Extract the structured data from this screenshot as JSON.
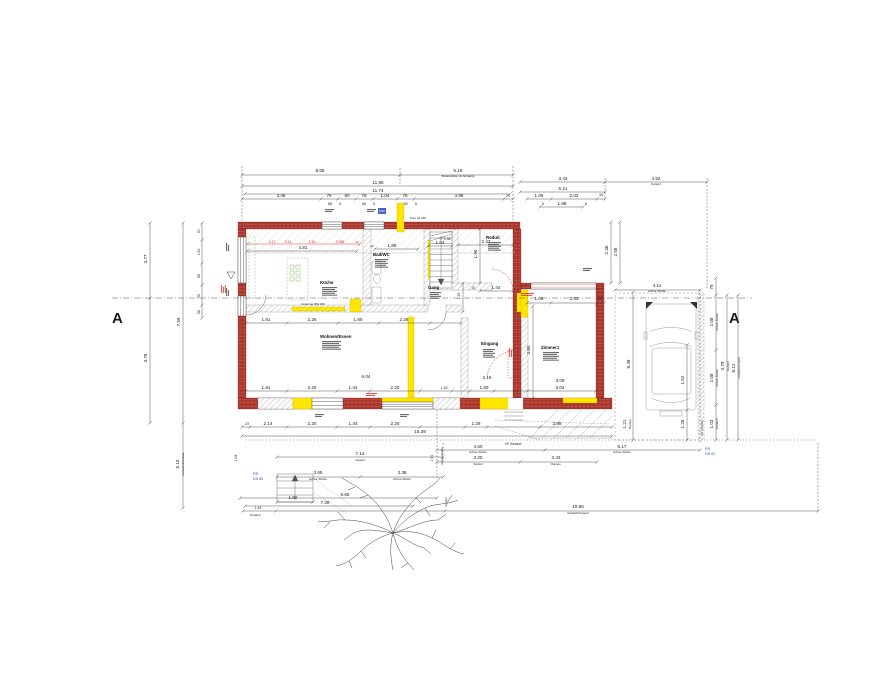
{
  "drawing": {
    "type": "floor-plan-ground-floor"
  },
  "section": {
    "left_marker": "A",
    "right_marker": "A"
  },
  "drains": {
    "left": {
      "line1": "RR",
      "line2": "DN 80"
    },
    "right": {
      "line1": "RR",
      "line2": "DN 60"
    }
  },
  "colors": {
    "wall_red": "#b13a31",
    "wall_red_dark": "#7a2018",
    "highlight_yellow": "#ffe600",
    "hatch_gray": "#9a9a9a",
    "kitchen_green": "#86bf6e",
    "dim_text": "#1a1a1a",
    "red_text": "#d02c1e",
    "blue_text": "#3a57c4",
    "line_gray": "#444444"
  },
  "rooms": [
    {
      "name": "Küche",
      "x": 320,
      "y": 284
    },
    {
      "name": "Bad/WC",
      "x": 373,
      "y": 256
    },
    {
      "name": "Gang",
      "x": 428,
      "y": 289
    },
    {
      "name": "Reduit",
      "x": 486,
      "y": 239
    },
    {
      "name": "Zimmer1",
      "x": 541,
      "y": 349
    },
    {
      "name": "Wohnen/Essen",
      "x": 320,
      "y": 338
    },
    {
      "name": "Eingang",
      "x": 481,
      "y": 345
    }
  ],
  "dim_lines": [
    {
      "x1": 242,
      "y1": 175,
      "x2": 400,
      "y2": 175
    },
    {
      "x1": 400,
      "y1": 175,
      "x2": 513,
      "y2": 175
    },
    {
      "x1": 242,
      "y1": 186,
      "x2": 513,
      "y2": 186
    },
    {
      "x1": 245,
      "y1": 194,
      "x2": 510,
      "y2": 194
    },
    {
      "x1": 242,
      "y1": 199,
      "x2": 513,
      "y2": 199,
      "ticks": [
        321,
        338,
        356,
        373,
        397,
        414,
        504
      ]
    },
    {
      "x1": 520,
      "y1": 182,
      "x2": 605,
      "y2": 182
    },
    {
      "x1": 605,
      "y1": 182,
      "x2": 707,
      "y2": 182
    },
    {
      "x1": 520,
      "y1": 192,
      "x2": 605,
      "y2": 192
    },
    {
      "x1": 527,
      "y1": 199,
      "x2": 605,
      "y2": 199,
      "ticks": [
        551,
        597
      ]
    },
    {
      "x1": 540,
      "y1": 207,
      "x2": 583,
      "y2": 207
    },
    {
      "x1": 611,
      "y1": 222,
      "x2": 611,
      "y2": 283
    },
    {
      "x1": 620,
      "y1": 222,
      "x2": 620,
      "y2": 283
    },
    {
      "x1": 615,
      "y1": 290,
      "x2": 700,
      "y2": 290
    },
    {
      "x1": 716,
      "y1": 278,
      "x2": 716,
      "y2": 440,
      "ticks": [
        295,
        350,
        405
      ]
    },
    {
      "x1": 727,
      "y1": 295,
      "x2": 727,
      "y2": 440
    },
    {
      "x1": 738,
      "y1": 295,
      "x2": 738,
      "y2": 440
    },
    {
      "x1": 150,
      "y1": 223,
      "x2": 150,
      "y2": 423,
      "ticks": [
        298
      ]
    },
    {
      "x1": 183,
      "y1": 223,
      "x2": 183,
      "y2": 508,
      "ticks": [
        423
      ]
    },
    {
      "x1": 202,
      "y1": 223,
      "x2": 202,
      "y2": 318,
      "ticks": [
        240,
        263,
        285,
        305
      ]
    },
    {
      "x1": 633,
      "y1": 292,
      "x2": 633,
      "y2": 440
    },
    {
      "x1": 687,
      "y1": 345,
      "x2": 687,
      "y2": 440,
      "ticks": [
        410
      ]
    },
    {
      "x1": 246,
      "y1": 391,
      "x2": 596,
      "y2": 391,
      "ticks": [
        287,
        337,
        370,
        420,
        452,
        470,
        494,
        528
      ]
    },
    {
      "x1": 242,
      "y1": 427,
      "x2": 612,
      "y2": 427,
      "ticks": [
        250,
        287,
        337,
        370,
        420,
        465,
        487,
        540
      ]
    },
    {
      "x1": 242,
      "y1": 436,
      "x2": 612,
      "y2": 436
    },
    {
      "x1": 277,
      "y1": 457,
      "x2": 443,
      "y2": 457
    },
    {
      "x1": 437,
      "y1": 450,
      "x2": 700,
      "y2": 450,
      "ticks": [
        545
      ]
    },
    {
      "x1": 437,
      "y1": 462,
      "x2": 597,
      "y2": 462,
      "ticks": [
        520
      ]
    },
    {
      "x1": 277,
      "y1": 477,
      "x2": 443,
      "y2": 477,
      "ticks": [
        360
      ]
    },
    {
      "x1": 240,
      "y1": 498,
      "x2": 437,
      "y2": 498
    },
    {
      "x1": 245,
      "y1": 506,
      "x2": 413,
      "y2": 506
    },
    {
      "x1": 243,
      "y1": 511,
      "x2": 818,
      "y2": 511,
      "ticks": [
        276,
        445
      ]
    },
    {
      "x1": 277,
      "y1": 502,
      "x2": 313,
      "y2": 502
    },
    {
      "x1": 527,
      "y1": 303,
      "x2": 604,
      "y2": 303,
      "ticks": [
        551,
        597
      ]
    },
    {
      "x1": 458,
      "y1": 245,
      "x2": 513,
      "y2": 245
    },
    {
      "x1": 480,
      "y1": 229,
      "x2": 480,
      "y2": 283
    },
    {
      "x1": 480,
      "y1": 291,
      "x2": 513,
      "y2": 291
    },
    {
      "x1": 463,
      "y1": 283,
      "x2": 463,
      "y2": 312
    },
    {
      "x1": 375,
      "y1": 249,
      "x2": 418,
      "y2": 249
    },
    {
      "x1": 428,
      "y1": 246,
      "x2": 452,
      "y2": 246
    },
    {
      "x1": 247,
      "y1": 244,
      "x2": 360,
      "y2": 244,
      "c": "red"
    },
    {
      "x1": 247,
      "y1": 251,
      "x2": 357,
      "y2": 251
    },
    {
      "x1": 246,
      "y1": 323,
      "x2": 461,
      "y2": 323,
      "ticks": [
        287,
        338,
        379,
        430
      ]
    },
    {
      "x1": 533,
      "y1": 306,
      "x2": 533,
      "y2": 398
    },
    {
      "x1": 437,
      "y1": 410,
      "x2": 437,
      "y2": 480,
      "d": 1
    },
    {
      "x1": 242,
      "y1": 166,
      "x2": 242,
      "y2": 222,
      "d": 1
    },
    {
      "x1": 513,
      "y1": 166,
      "x2": 513,
      "y2": 222,
      "d": 1
    },
    {
      "x1": 400,
      "y1": 168,
      "x2": 400,
      "y2": 186,
      "d": 1
    },
    {
      "x1": 605,
      "y1": 178,
      "x2": 605,
      "y2": 199,
      "d": 1
    },
    {
      "x1": 707,
      "y1": 178,
      "x2": 707,
      "y2": 290,
      "d": 1
    },
    {
      "x1": 818,
      "y1": 443,
      "x2": 818,
      "y2": 511,
      "d": 1
    },
    {
      "x1": 245,
      "y1": 440,
      "x2": 818,
      "y2": 440,
      "d": 2
    },
    {
      "x1": 112,
      "y1": 298,
      "x2": 752,
      "y2": 298,
      "d": 3
    },
    {
      "x1": 246,
      "y1": 253,
      "x2": 513,
      "y2": 253,
      "c": "#bbbbbb"
    },
    {
      "x1": 443,
      "y1": 443,
      "x2": 443,
      "y2": 462,
      "d": 1
    },
    {
      "x1": 700,
      "y1": 290,
      "x2": 700,
      "y2": 443,
      "d": 1
    }
  ],
  "labels": [
    {
      "t": "8.65",
      "x": 320,
      "y": 172
    },
    {
      "t": "5.19",
      "x": 458,
      "y": 172
    },
    {
      "t": "Bodenplatte vor Eingang",
      "x": 458,
      "y": 177,
      "s": 3
    },
    {
      "t": "11.96",
      "x": 378,
      "y": 184
    },
    {
      "t": "11.74",
      "x": 378,
      "y": 192
    },
    {
      "t": "3.48",
      "x": 281,
      "y": 197
    },
    {
      "t": "76",
      "x": 329,
      "y": 197
    },
    {
      "t": "80",
      "x": 347,
      "y": 197
    },
    {
      "t": "76",
      "x": 364,
      "y": 197
    },
    {
      "t": "1.04",
      "x": 385,
      "y": 197
    },
    {
      "t": "76",
      "x": 405,
      "y": 197
    },
    {
      "t": "3.98",
      "x": 459,
      "y": 197
    },
    {
      "t": "22",
      "x": 508,
      "y": 197,
      "s": 3.5
    },
    {
      "t": "68",
      "x": 330,
      "y": 205,
      "s": 3.5
    },
    {
      "t": "5",
      "x": 340,
      "y": 205,
      "s": 3.5
    },
    {
      "t": "66",
      "x": 364,
      "y": 205,
      "s": 3.5
    },
    {
      "t": "5",
      "x": 374,
      "y": 205,
      "s": 3.5
    },
    {
      "t": "92",
      "x": 406,
      "y": 205,
      "s": 3.5
    },
    {
      "t": "6",
      "x": 416,
      "y": 205,
      "s": 3.5
    },
    {
      "t": "Knie eff.160",
      "x": 418,
      "y": 219,
      "s": 3
    },
    {
      "t": "3.43",
      "x": 563,
      "y": 180
    },
    {
      "t": "4.52",
      "x": 656,
      "y": 180
    },
    {
      "t": "Carport",
      "x": 656,
      "y": 185,
      "s": 3
    },
    {
      "t": "5.21",
      "x": 563,
      "y": 190
    },
    {
      "t": "1.06",
      "x": 539,
      "y": 197
    },
    {
      "t": "2.03",
      "x": 574,
      "y": 197
    },
    {
      "t": "34",
      "x": 601,
      "y": 196,
      "s": 3.5
    },
    {
      "t": "1.88",
      "x": 562,
      "y": 205
    },
    {
      "t": "6",
      "x": 543,
      "y": 205,
      "s": 3.5
    },
    {
      "t": "6",
      "x": 586,
      "y": 205,
      "s": 3.5
    },
    {
      "t": "2.36",
      "x": 608,
      "y": 250,
      "r": 1
    },
    {
      "t": "2.58",
      "x": 617,
      "y": 252,
      "r": 1
    },
    {
      "t": "4.11",
      "x": 657,
      "y": 287
    },
    {
      "t": "Achse Stütze",
      "x": 657,
      "y": 292,
      "s": 3
    },
    {
      "t": "76",
      "x": 713,
      "y": 287,
      "r": 1
    },
    {
      "t": "2.08",
      "x": 713,
      "y": 322,
      "r": 1
    },
    {
      "t": "Achse Stütze",
      "x": 718,
      "y": 322,
      "s": 3,
      "r": 1
    },
    {
      "t": "2.08",
      "x": 713,
      "y": 378,
      "r": 1
    },
    {
      "t": "Achse Stütze",
      "x": 718,
      "y": 378,
      "s": 3,
      "r": 1
    },
    {
      "t": "1.03",
      "x": 713,
      "y": 424,
      "r": 1
    },
    {
      "t": "Vordach",
      "x": 718,
      "y": 424,
      "s": 3,
      "r": 1
    },
    {
      "t": "4.79",
      "x": 724,
      "y": 366,
      "r": 1
    },
    {
      "t": "Carport",
      "x": 729,
      "y": 366,
      "s": 3,
      "r": 1
    },
    {
      "t": "8.12",
      "x": 735,
      "y": 368,
      "r": 1
    },
    {
      "t": "Vordach/Carport",
      "x": 740,
      "y": 368,
      "s": 3,
      "r": 1
    },
    {
      "t": "VK Vordach",
      "x": 703,
      "y": 428,
      "s": 3,
      "r": 1
    },
    {
      "t": "3.77",
      "x": 147,
      "y": 259,
      "r": 1
    },
    {
      "t": "3.78",
      "x": 147,
      "y": 358,
      "r": 1
    },
    {
      "t": "7.59",
      "x": 180,
      "y": 322,
      "r": 1
    },
    {
      "t": "5.10",
      "x": 179,
      "y": 464,
      "r": 1
    },
    {
      "t": "Vordach/Postkast.",
      "x": 184,
      "y": 464,
      "s": 3,
      "r": 1
    },
    {
      "t": "61",
      "x": 200,
      "y": 231,
      "r": 1,
      "s": 3.5
    },
    {
      "t": "1.62",
      "x": 200,
      "y": 252,
      "r": 1,
      "s": 3.5
    },
    {
      "t": "58",
      "x": 200,
      "y": 276,
      "r": 1,
      "s": 3.5
    },
    {
      "t": "95",
      "x": 200,
      "y": 296,
      "r": 1,
      "s": 3.5
    },
    {
      "t": "58",
      "x": 200,
      "y": 312,
      "r": 1,
      "s": 3.5
    },
    {
      "t": "8.48",
      "x": 630,
      "y": 364,
      "r": 1
    },
    {
      "t": "1.21",
      "x": 626,
      "y": 424,
      "r": 1
    },
    {
      "t": "Rampe",
      "x": 631,
      "y": 424,
      "s": 3,
      "r": 1
    },
    {
      "t": "1.52",
      "x": 684,
      "y": 380,
      "r": 1
    },
    {
      "t": "1.26",
      "x": 684,
      "y": 424,
      "r": 1
    },
    {
      "t": "1.81",
      "x": 266,
      "y": 389
    },
    {
      "t": "2.20",
      "x": 312,
      "y": 389
    },
    {
      "t": "1.44",
      "x": 353,
      "y": 389
    },
    {
      "t": "2.20",
      "x": 395,
      "y": 389
    },
    {
      "t": "1.18",
      "x": 444,
      "y": 389,
      "s": 3.5
    },
    {
      "t": "1.50",
      "x": 484,
      "y": 389
    },
    {
      "t": "2.19",
      "x": 487,
      "y": 379
    },
    {
      "t": "3.09",
      "x": 560,
      "y": 382
    },
    {
      "t": "3.04",
      "x": 560,
      "y": 389
    },
    {
      "t": "6.04",
      "x": 366,
      "y": 378
    },
    {
      "t": "23",
      "x": 247,
      "y": 425,
      "s": 3.5
    },
    {
      "t": "2.14",
      "x": 268,
      "y": 425
    },
    {
      "t": "2.20",
      "x": 312,
      "y": 425
    },
    {
      "t": "1.44",
      "x": 353,
      "y": 425
    },
    {
      "t": "2.20",
      "x": 395,
      "y": 425
    },
    {
      "t": "1.29",
      "x": 476,
      "y": 425
    },
    {
      "t": "3.89",
      "x": 557,
      "y": 425
    },
    {
      "t": "15.39",
      "x": 420,
      "y": 433
    },
    {
      "t": "7.14",
      "x": 360,
      "y": 455
    },
    {
      "t": "Sockel",
      "x": 360,
      "y": 461,
      "s": 3
    },
    {
      "t": "4.50",
      "x": 478,
      "y": 448
    },
    {
      "t": "Achse Stütze",
      "x": 478,
      "y": 453,
      "s": 3
    },
    {
      "t": "6.17",
      "x": 622,
      "y": 448
    },
    {
      "t": "Achse Stütze",
      "x": 622,
      "y": 453,
      "s": 3
    },
    {
      "t": "3.20",
      "x": 478,
      "y": 459
    },
    {
      "t": "Sockel",
      "x": 478,
      "y": 465,
      "s": 3
    },
    {
      "t": "3.43",
      "x": 556,
      "y": 459
    },
    {
      "t": "Rampe",
      "x": 556,
      "y": 465,
      "s": 3
    },
    {
      "t": "3.65",
      "x": 318,
      "y": 474
    },
    {
      "t": "Achse Stütze",
      "x": 318,
      "y": 480,
      "s": 3
    },
    {
      "t": "3.38",
      "x": 402,
      "y": 474
    },
    {
      "t": "Achse Stütze",
      "x": 402,
      "y": 480,
      "s": 3
    },
    {
      "t": "8.66",
      "x": 345,
      "y": 496
    },
    {
      "t": "7.39",
      "x": 325,
      "y": 504
    },
    {
      "t": "1.80",
      "x": 293,
      "y": 499
    },
    {
      "t": "1.44",
      "x": 258,
      "y": 509,
      "s": 3.5
    },
    {
      "t": "10.86",
      "x": 578,
      "y": 508
    },
    {
      "t": "Vordach/Carport",
      "x": 578,
      "y": 514,
      "s": 3
    },
    {
      "t": "Vordach",
      "x": 255,
      "y": 516,
      "s": 3
    },
    {
      "t": "VK Vordach",
      "x": 513,
      "y": 445,
      "s": 3.2
    },
    {
      "t": "1.91",
      "x": 433,
      "y": 458,
      "r": 1,
      "s": 3.5
    },
    {
      "t": "Achse Stütze",
      "x": 443,
      "y": 456,
      "s": 3,
      "r": 1
    },
    {
      "t": "1.04",
      "x": 237,
      "y": 458,
      "r": 1,
      "s": 3.5
    },
    {
      "t": "Sockel",
      "x": 447,
      "y": 502,
      "s": 3,
      "r": 1
    },
    {
      "t": "3.17",
      "x": 272,
      "y": 243,
      "s": 3.5,
      "c": "red"
    },
    {
      "t": "2.14",
      "x": 288,
      "y": 243,
      "s": 3.5,
      "c": "red"
    },
    {
      "t": "1.40",
      "x": 312,
      "y": 243,
      "s": 3.5,
      "c": "red"
    },
    {
      "t": "2.055",
      "x": 340,
      "y": 243,
      "s": 3.5,
      "c": "red"
    },
    {
      "t": "12",
      "x": 357,
      "y": 243,
      "s": 3,
      "c": "red"
    },
    {
      "t": "4.81",
      "x": 303,
      "y": 249
    },
    {
      "t": "1.88",
      "x": 392,
      "y": 247
    },
    {
      "t": "12",
      "x": 372,
      "y": 247,
      "s": 3
    },
    {
      "t": "1.04",
      "x": 440,
      "y": 244
    },
    {
      "t": "2.38",
      "x": 447,
      "y": 240,
      "s": 3.5
    },
    {
      "t": "2.47",
      "x": 486,
      "y": 243
    },
    {
      "t": "1.90",
      "x": 477,
      "y": 254,
      "r": 1
    },
    {
      "t": "1.44",
      "x": 496,
      "y": 289
    },
    {
      "t": "15",
      "x": 473,
      "y": 289,
      "s": 3.2
    },
    {
      "t": "1.29",
      "x": 460,
      "y": 296,
      "r": 1,
      "s": 3.5
    },
    {
      "t": "1.06",
      "x": 539,
      "y": 300
    },
    {
      "t": "2.03",
      "x": 574,
      "y": 300
    },
    {
      "t": "34",
      "x": 600,
      "y": 299,
      "s": 3.5
    },
    {
      "t": "3.65",
      "x": 530,
      "y": 350,
      "r": 1
    },
    {
      "t": "1.81",
      "x": 266,
      "y": 321
    },
    {
      "t": "2.26",
      "x": 312,
      "y": 321
    },
    {
      "t": "1.80",
      "x": 358,
      "y": 321
    },
    {
      "t": "2.26",
      "x": 404,
      "y": 321
    },
    {
      "t": "Unterzug IPE 200",
      "x": 313,
      "y": 305,
      "s": 3
    }
  ],
  "bars": [
    {
      "x": 322,
      "y": 287,
      "w": 15,
      "n": 5
    },
    {
      "x": 322,
      "y": 341,
      "w": 19,
      "n": 5
    },
    {
      "x": 375,
      "y": 259,
      "w": 13,
      "n": 5
    },
    {
      "x": 430,
      "y": 292,
      "w": 11,
      "n": 4
    },
    {
      "x": 488,
      "y": 242,
      "w": 13,
      "n": 5
    },
    {
      "x": 543,
      "y": 352,
      "w": 16,
      "n": 5
    },
    {
      "x": 483,
      "y": 349,
      "w": 12,
      "n": 5
    },
    {
      "x": 325,
      "y": 209,
      "w": 9,
      "n": 2
    },
    {
      "x": 367,
      "y": 209,
      "w": 9,
      "n": 2
    },
    {
      "x": 315,
      "y": 414,
      "w": 9,
      "n": 2
    },
    {
      "x": 400,
      "y": 414,
      "w": 9,
      "n": 2
    },
    {
      "x": 583,
      "y": 268,
      "w": 9,
      "n": 2
    },
    {
      "x": 226,
      "y": 251,
      "w": 8,
      "n": 2,
      "r": 1
    },
    {
      "x": 226,
      "y": 296,
      "w": 8,
      "n": 2,
      "r": 1
    },
    {
      "x": 521,
      "y": 293,
      "w": 13,
      "n": 2,
      "c": "red"
    },
    {
      "x": 366,
      "y": 393,
      "w": 11,
      "n": 2,
      "c": "red"
    },
    {
      "x": 221,
      "y": 293,
      "w": 8,
      "n": 3,
      "c": "red",
      "r": 1
    },
    {
      "x": 509,
      "y": 357,
      "w": 9,
      "n": 2,
      "c": "red",
      "r": 1
    }
  ]
}
